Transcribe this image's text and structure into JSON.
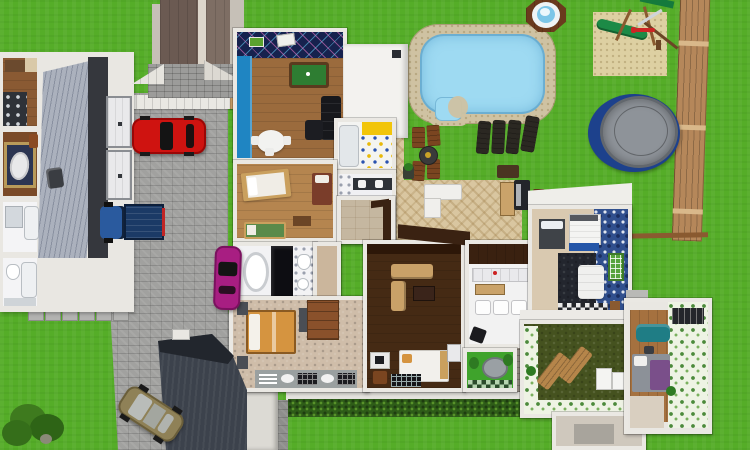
{
  "scene": {
    "description": "Aerial 3D dollhouse render of a home design project: multi-room house with cutaway roof, left neighbor house with garage, stone driveway with four vehicles, backyard with swimming pool, hot tub, playground sandbox, trampoline, wood fence, patio with outdoor furniture and lawn",
    "colors": {
      "grass": "#55ad28",
      "driveway": "#a1a19f",
      "walkway_white": "#e9e8e3",
      "walkway_wood": "#c49a63",
      "tower_roof_dark": "#6b5a52",
      "tower_roof_mid": "#7e6e64",
      "tower_ridge": "#ddd6cb",
      "tower_edge": "#c6c0b7",
      "tower_stone": "#9c9c9a",
      "left_house_siding": "#abb1bd",
      "left_house_dark_wall": "#35373d",
      "garage_door": "#e9e9eb",
      "red_car": "#cf1310",
      "truck_cab": "#2a5a9e",
      "truck_bed": "#1b3a66",
      "magenta_car": "#a81e82",
      "tan_car": "#8f8157",
      "garage_slab": "#3c424c",
      "garage_slab_front": "#22262d",
      "pool_deck": "#cfc2a2",
      "pool_water": "#9edaf2",
      "hot_tub_wood": "#6a3a1d",
      "hot_tub_water": "#7cc6e8",
      "sand": "#ddd0a2",
      "play_green": "#1c8a46",
      "fence_wood": "#b5875a",
      "rail_wood": "#8a5a30",
      "trampoline_ring": "#1d418c",
      "trampoline_mat": "#8e9399",
      "patio_tile": "#d9c6a0",
      "hedge": "#2e5c18",
      "house_wall": "#eae8e3",
      "gameroom_floor": "#9b6b3d",
      "gameroom_blue_wall": "#1f85c2",
      "argyle_wall": "#16224e",
      "pool_table": "#2e7d32",
      "kitchen_yellow": "#f2c50a",
      "kids_floor": "#b5854f",
      "dining_floor": "#c5b7a0",
      "master_floor": "#cfbda9",
      "family_floor": "#452a14",
      "black_bath": "#0d0d12",
      "wing_navy_floor": "#23262e",
      "window_green": "#57a33c",
      "green_nook_floor": "#3fa32c",
      "green_room_floor": "#45521f",
      "teal_sofa": "#1f7d85",
      "purple_bed": "#7a4f8a",
      "plank_floor": "#a5713f",
      "beige_room": "#cfc8bd",
      "brown_chair": "#7a4520",
      "lounger_dark": "#2b2822",
      "sofa_tan": "#c9a168",
      "bed_orange": "#d59440",
      "fire_pit": "#3a3a3a",
      "fire_pit_gold": "#c9a227",
      "tree_green": "#3e7a1e"
    },
    "objects": {
      "pool": "swimming pool with stone deck and corner steps",
      "hot_tub": "octagonal wooden hot tub",
      "playground": "sandbox with green slide and swing set",
      "trampoline": "round trampoline",
      "fence": "vertical wood plank fence with rail",
      "vehicles": [
        "red sedan",
        "blue pickup truck",
        "magenta car",
        "tan car"
      ],
      "outdoor": [
        "dark lounge chairs",
        "wood patio chairs",
        "fire pit",
        "white sectional sofa",
        "grill",
        "bench",
        "planter",
        "hedge",
        "stepping stones",
        "tree"
      ],
      "left_house": [
        "kitchen",
        "rug room with mirror",
        "two bathrooms",
        "siding roof",
        "garage doors"
      ],
      "main_house_rooms": [
        "game room with billiards table",
        "flat roof section",
        "kitchen with daisy floor",
        "bathroom with double vanity",
        "kids bedroom with three beds",
        "dining nook",
        "black master bathroom",
        "master bedroom",
        "family room",
        "white kitchen-bath",
        "green reading nook",
        "guest bedroom with mosaic wall",
        "green sun room",
        "far-right bedroom with teal sofa",
        "beige utility room"
      ]
    }
  }
}
